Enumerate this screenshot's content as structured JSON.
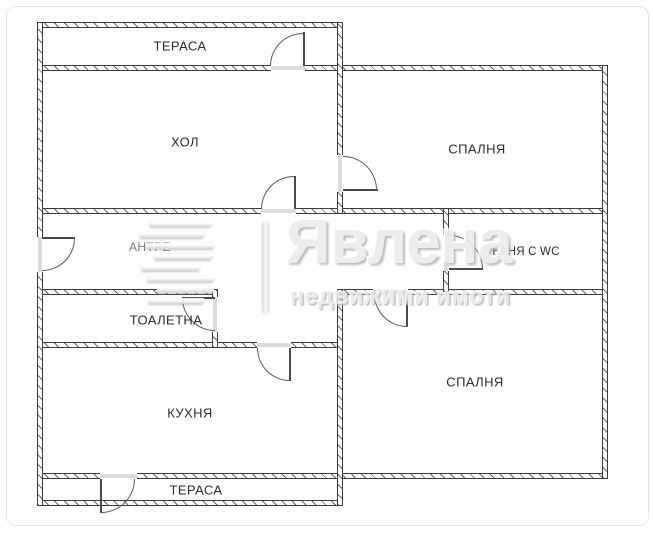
{
  "rooms": {
    "terrace_top": {
      "label": "ТЕРАСА"
    },
    "hall": {
      "label": "ХОЛ"
    },
    "bedroom_top": {
      "label": "СПАЛНЯ"
    },
    "antre": {
      "label": "АНТРЕ"
    },
    "bath_wc": {
      "label": "БАНЯ С WC"
    },
    "toilet": {
      "label": "ТОАЛЕТНА"
    },
    "kitchen": {
      "label": "КУХНЯ"
    },
    "bedroom_bottom": {
      "label": "СПАЛНЯ"
    },
    "terrace_bottom": {
      "label": "ТЕРАСА"
    }
  },
  "watermark": {
    "brand": "Явлена",
    "tagline": "недвижими имоти"
  },
  "colors": {
    "background": "#ffffff",
    "wall_line": "#3c3c3c",
    "label_text": "#2b2b2b",
    "watermark_gray": "#ececec"
  }
}
